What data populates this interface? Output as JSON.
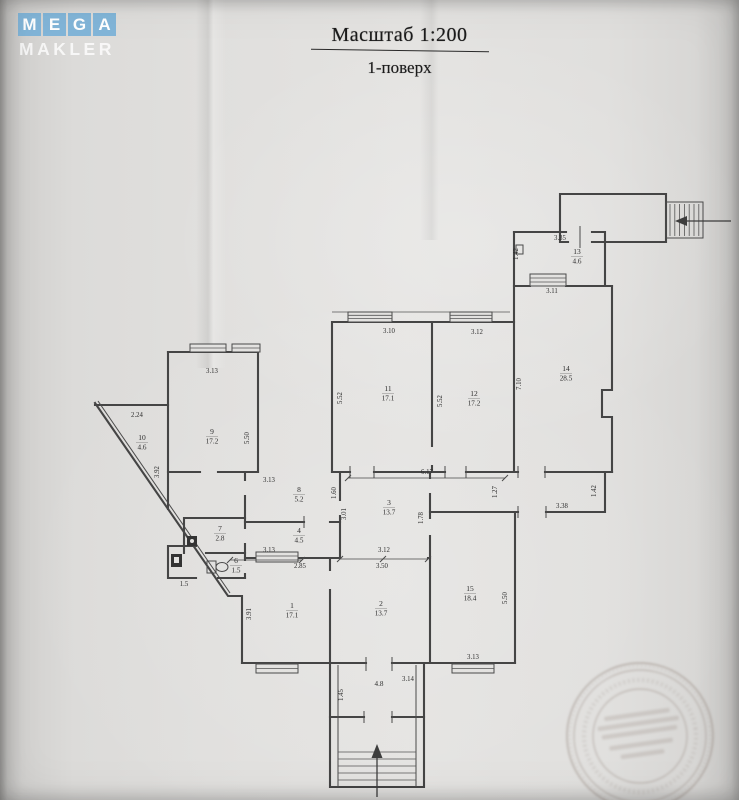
{
  "watermark": {
    "line1": "MEGA",
    "line2": "MAKLER",
    "tile_color": "#82b5d8",
    "text_color": "#ffffff"
  },
  "title": {
    "scale_label": "Масштаб 1:200",
    "floor_label": "1-поверх"
  },
  "floor_plan": {
    "rooms": [
      {
        "number": "13",
        "area": "4.6",
        "x": 577,
        "y": 254
      },
      {
        "number": "14",
        "area": "28.5",
        "x": 566,
        "y": 371
      },
      {
        "number": "11",
        "area": "17.1",
        "x": 388,
        "y": 391
      },
      {
        "number": "12",
        "area": "17.2",
        "x": 474,
        "y": 396
      },
      {
        "number": "9",
        "area": "17.2",
        "x": 212,
        "y": 434
      },
      {
        "number": "10",
        "area": "4.6",
        "x": 142,
        "y": 440
      },
      {
        "number": "8",
        "area": "5.2",
        "x": 299,
        "y": 492
      },
      {
        "number": "3",
        "area": "13.7",
        "x": 389,
        "y": 505
      },
      {
        "number": "4",
        "area": "4.5",
        "x": 299,
        "y": 533
      },
      {
        "number": "7",
        "area": "2.8",
        "x": 220,
        "y": 531
      },
      {
        "number": "6",
        "area": "1.5",
        "x": 236,
        "y": 563
      },
      {
        "number": "1",
        "area": "17.1",
        "x": 292,
        "y": 608
      },
      {
        "number": "2",
        "area": "13.7",
        "x": 381,
        "y": 606
      },
      {
        "number": "15",
        "area": "18.4",
        "x": 470,
        "y": 591
      },
      {
        "number": "",
        "area": "4.8",
        "x": 379,
        "y": 686
      }
    ],
    "dimensions": [
      {
        "text": "3.35",
        "x": 560,
        "y": 240,
        "rot": 0
      },
      {
        "text": "1.42",
        "x": 518,
        "y": 254,
        "rot": -90
      },
      {
        "text": "3.11",
        "x": 552,
        "y": 293,
        "rot": 0
      },
      {
        "text": "3.10",
        "x": 389,
        "y": 333,
        "rot": 0
      },
      {
        "text": "3.12",
        "x": 477,
        "y": 334,
        "rot": 0
      },
      {
        "text": "3.13",
        "x": 212,
        "y": 373,
        "rot": 0
      },
      {
        "text": "5.52",
        "x": 342,
        "y": 398,
        "rot": -90
      },
      {
        "text": "5.52",
        "x": 442,
        "y": 401,
        "rot": -90
      },
      {
        "text": "7.10",
        "x": 521,
        "y": 384,
        "rot": -90
      },
      {
        "text": "2.24",
        "x": 137,
        "y": 417,
        "rot": 0
      },
      {
        "text": "5.50",
        "x": 249,
        "y": 438,
        "rot": -90
      },
      {
        "text": "3.92",
        "x": 159,
        "y": 472,
        "rot": -90
      },
      {
        "text": "3.13",
        "x": 269,
        "y": 482,
        "rot": 0
      },
      {
        "text": "6.17",
        "x": 427,
        "y": 474,
        "rot": 0
      },
      {
        "text": "1.27",
        "x": 497,
        "y": 492,
        "rot": -90
      },
      {
        "text": "1.42",
        "x": 596,
        "y": 491,
        "rot": -90
      },
      {
        "text": "3.38",
        "x": 562,
        "y": 508,
        "rot": 0
      },
      {
        "text": "1.60",
        "x": 336,
        "y": 493,
        "rot": -90
      },
      {
        "text": "3.01",
        "x": 346,
        "y": 514,
        "rot": -90
      },
      {
        "text": "1.78",
        "x": 423,
        "y": 518,
        "rot": -90
      },
      {
        "text": "3.13",
        "x": 269,
        "y": 552,
        "rot": 0
      },
      {
        "text": "2.85",
        "x": 300,
        "y": 568,
        "rot": 0
      },
      {
        "text": "3.12",
        "x": 384,
        "y": 552,
        "rot": 0
      },
      {
        "text": "3.50",
        "x": 382,
        "y": 568,
        "rot": 0
      },
      {
        "text": "3.91",
        "x": 251,
        "y": 614,
        "rot": -90
      },
      {
        "text": "5.50",
        "x": 507,
        "y": 598,
        "rot": -90
      },
      {
        "text": "3.13",
        "x": 473,
        "y": 659,
        "rot": 0
      },
      {
        "text": "3.14",
        "x": 408,
        "y": 681,
        "rot": 0
      },
      {
        "text": "1.45",
        "x": 343,
        "y": 695,
        "rot": -90
      },
      {
        "text": "1.5",
        "x": 184,
        "y": 586,
        "rot": 0
      }
    ]
  }
}
